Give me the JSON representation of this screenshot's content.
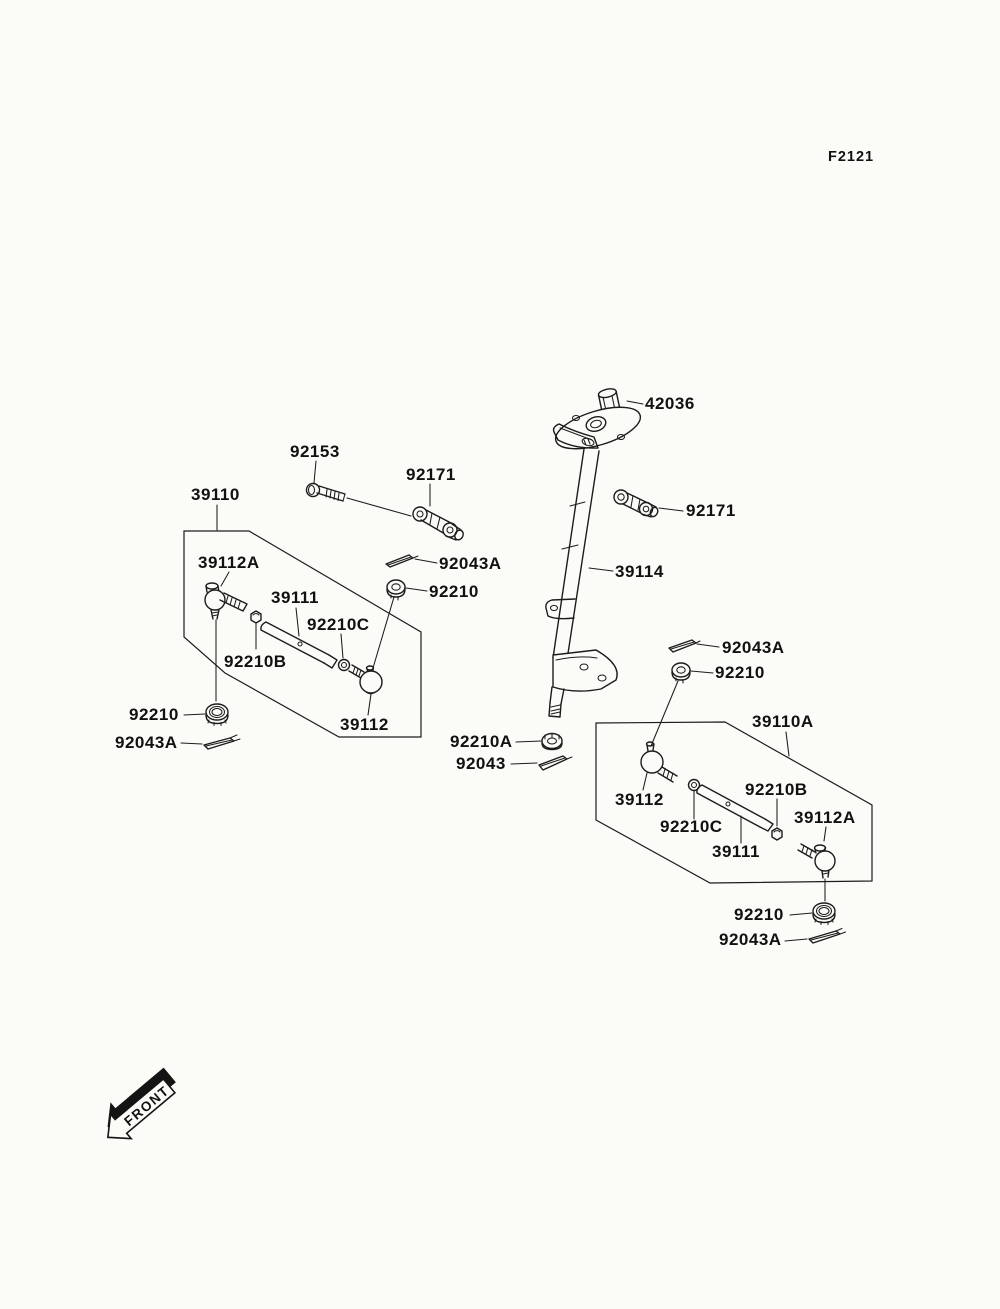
{
  "page": {
    "figure_code": "F2121",
    "front_label": "FRONT",
    "background_color": "#fbfcf8",
    "line_color": "#1c1c1c"
  },
  "callouts": [
    {
      "id": "42036",
      "text": "42036"
    },
    {
      "id": "92153",
      "text": "92153"
    },
    {
      "id": "92171-upper",
      "text": "92171"
    },
    {
      "id": "39110",
      "text": "39110"
    },
    {
      "id": "39112a-left",
      "text": "39112A"
    },
    {
      "id": "92043a-center",
      "text": "92043A"
    },
    {
      "id": "92210-center",
      "text": "92210"
    },
    {
      "id": "39111-left",
      "text": "39111"
    },
    {
      "id": "92210c-left",
      "text": "92210C"
    },
    {
      "id": "39114",
      "text": "39114"
    },
    {
      "id": "92171-right",
      "text": "92171"
    },
    {
      "id": "92043a-right",
      "text": "92043A"
    },
    {
      "id": "92210-right",
      "text": "92210"
    },
    {
      "id": "92210b-left",
      "text": "92210B"
    },
    {
      "id": "92210-bottom-left",
      "text": "92210"
    },
    {
      "id": "92043a-bottom-left",
      "text": "92043A"
    },
    {
      "id": "39112-left",
      "text": "39112"
    },
    {
      "id": "92210a",
      "text": "92210A"
    },
    {
      "id": "92043",
      "text": "92043"
    },
    {
      "id": "39110a",
      "text": "39110A"
    },
    {
      "id": "39112-right",
      "text": "39112"
    },
    {
      "id": "92210b-right",
      "text": "92210B"
    },
    {
      "id": "39112a-right",
      "text": "39112A"
    },
    {
      "id": "92210c-right",
      "text": "92210C"
    },
    {
      "id": "39111-right",
      "text": "39111"
    },
    {
      "id": "92210-bottom-right",
      "text": "92210"
    },
    {
      "id": "92043a-bottom-right",
      "text": "92043A"
    }
  ]
}
